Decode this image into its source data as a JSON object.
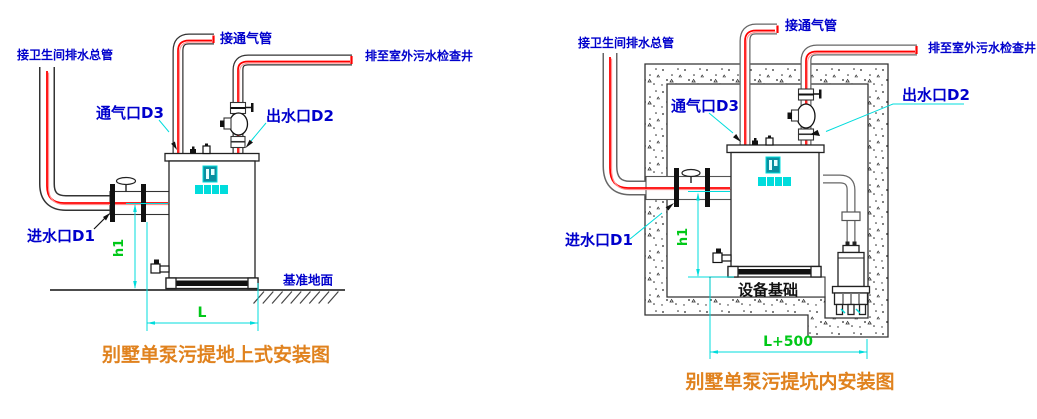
{
  "colors": {
    "label_blue": "#0000CC",
    "dimension_green": "#00C818",
    "leader_cyan": "#00DCDC",
    "title_orange": "#E0821E",
    "pipe_red": "#FF0000",
    "pipe_pink": "#FF8F8F"
  },
  "left_diagram": {
    "title": "别墅单泵污提地上式安装图",
    "labels": {
      "toilet_main": "接卫生间排水总管",
      "vent_connect": "接通气管",
      "outdoor_well": "排至室外污水检查井",
      "vent_port": "通气口D3",
      "outlet_port": "出水口D2",
      "inlet_port": "进水口D1",
      "ground": "基准地面"
    },
    "dimensions": {
      "height": "h1",
      "length": "L"
    }
  },
  "right_diagram": {
    "title": "别墅单泵污提坑内安装图",
    "labels": {
      "toilet_main": "接卫生间排水总管",
      "vent_connect": "接通气管",
      "outdoor_well": "排至室外污水检查井",
      "vent_port": "通气口D3",
      "outlet_port": "出水口D2",
      "inlet_port": "进水口D1",
      "foundation": "设备基础"
    },
    "dimensions": {
      "height": "h1",
      "length": "L+500"
    }
  }
}
